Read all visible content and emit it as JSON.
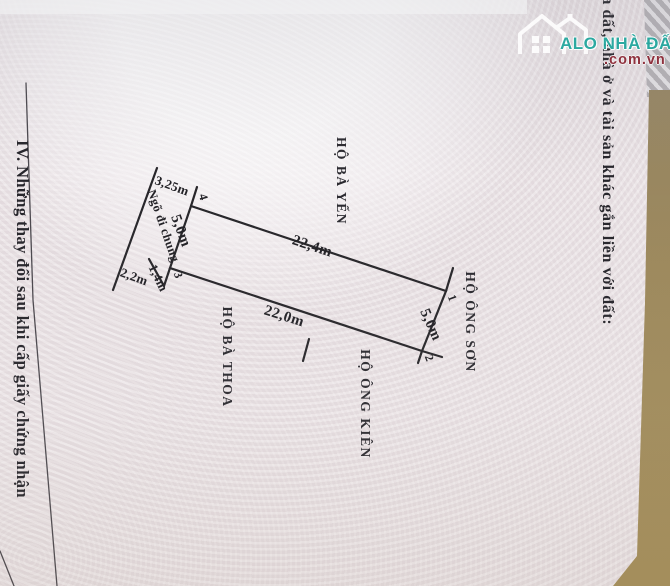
{
  "logo": {
    "line1": "ALO NHÀ ĐẤT",
    "line2": ".com.vn",
    "teal": "#23a79e",
    "maroon": "#8c2936"
  },
  "headers": {
    "section_iii_partial": "đồ thửa đất, nhà ở và tài sản khác gắn liền với đất:",
    "section_iv": "IV. Những thay đổi sau khi cấp giấy chứng nhận"
  },
  "diagram": {
    "neighbors": {
      "top": "HỘ BÀ YẾN",
      "right": "HỘ ÔNG SƠN",
      "bottom_left": "HỘ BÀ THOA",
      "bottom_right": "HỘ ÔNG KIÊN"
    },
    "alley_label": "Ngõ đi chung",
    "dimensions": {
      "top_edge": "22,4m",
      "bottom_edge": "22,0m",
      "right_edge": "5,0m",
      "left_edge": "5,0m",
      "alley_top": "3,25m",
      "alley_bottom": "2,2m",
      "notch": "1,4m"
    },
    "corners": {
      "c1": "1",
      "c2": "2",
      "c3": "3",
      "c4": "4"
    }
  },
  "colors": {
    "paper_pink": "#e7dfe2",
    "pattern_white": "#f6f3f5",
    "line_dark": "#27262a",
    "table_surface_tan": "#9c885c"
  }
}
